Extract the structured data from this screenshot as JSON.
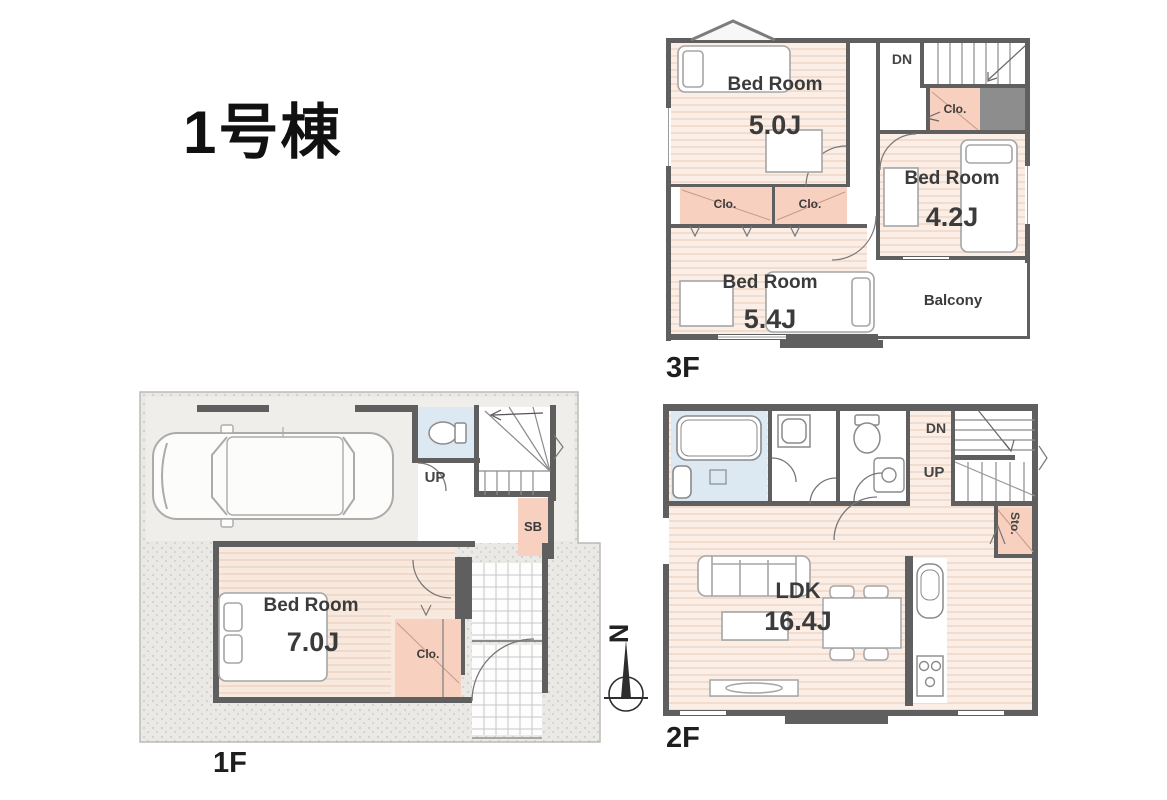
{
  "title": "1号棟",
  "shared": {
    "clo": "Clo.",
    "dn": "DN",
    "up": "UP",
    "balcony": "Balcony",
    "sb": "SB",
    "sto": "Sto.",
    "north": "N"
  },
  "floor3": {
    "label": "3F",
    "bedroom_a": {
      "name": "Bed Room",
      "size": "5.0J"
    },
    "bedroom_b": {
      "name": "Bed Room",
      "size": "4.2J"
    },
    "bedroom_c": {
      "name": "Bed Room",
      "size": "5.4J"
    }
  },
  "floor2": {
    "label": "2F",
    "ldk": {
      "name": "LDK",
      "size": "16.4J"
    }
  },
  "floor1": {
    "label": "1F",
    "bedroom": {
      "name": "Bed Room",
      "size": "7.0J"
    }
  },
  "colors": {
    "wall": "#5f5f5f",
    "wood_stripe_light": "#fbeee6",
    "wood_stripe_dark": "#f2dccd",
    "closet": "#f7d0bf",
    "water_blue": "#dde9f2",
    "site_gray": "#ebe9e6",
    "dark_fill": "#8d8d8d"
  }
}
